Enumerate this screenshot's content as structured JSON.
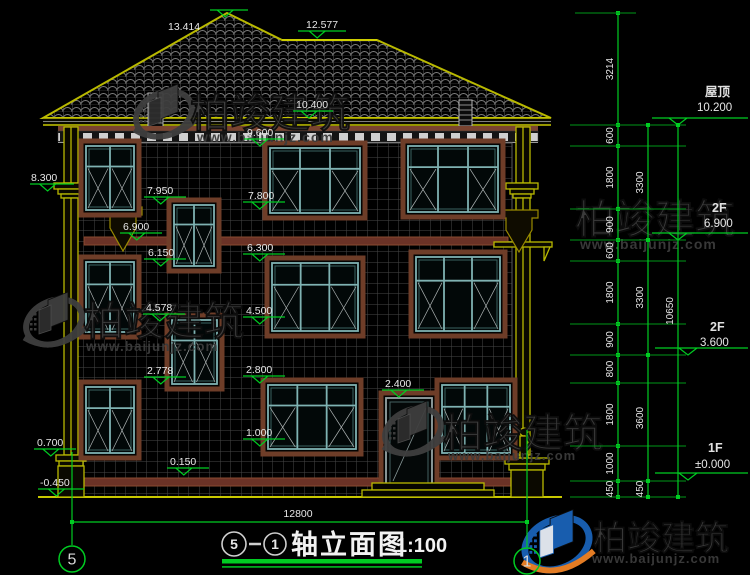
{
  "title": {
    "from": "5",
    "sep": "—",
    "to": "1",
    "name": "轴立面图",
    "scale": "1:100"
  },
  "bottom": {
    "overall_dim": "12800",
    "axis_left": "5",
    "axis_right": "1"
  },
  "watermark": {
    "brand": "柏竣建筑",
    "url": "www.baijunjz.com",
    "instances": [
      {
        "lx": 164,
        "ly": 114,
        "bx": 190,
        "by": 127,
        "bs": 40,
        "ux": 197,
        "uy": 142,
        "us": 14,
        "variant": "gray",
        "logo": true
      },
      {
        "lx": 54,
        "ly": 322,
        "bx": 84,
        "by": 335,
        "bs": 40,
        "ux": 86,
        "uy": 351,
        "us": 13.5,
        "variant": "gray",
        "logo": true
      },
      {
        "lx": 413,
        "ly": 431,
        "bx": 443,
        "by": 447,
        "bs": 40,
        "ux": 448,
        "uy": 460,
        "us": 13,
        "variant": "gray",
        "logo": true
      },
      {
        "lx": 540,
        "ly": 215,
        "bx": 575,
        "by": 233,
        "bs": 40,
        "ux": 580,
        "uy": 249,
        "us": 14,
        "variant": "gray",
        "logo": false
      },
      {
        "lx": 557,
        "ly": 544,
        "bx": 593,
        "by": 550,
        "bs": 34,
        "ux": 592,
        "uy": 563,
        "us": 13,
        "variant": "color",
        "logo": true
      }
    ]
  },
  "elevation_markers": [
    {
      "l": "13.414",
      "y": 17,
      "lx": 210,
      "lw": 38,
      "tx": 168,
      "ty": 30
    },
    {
      "l": "12.577",
      "y": 38,
      "lx": 298,
      "lw": 48,
      "tx": 306,
      "ty": 28
    },
    {
      "l": "10.400",
      "y": 118,
      "lx": 293,
      "lw": 40,
      "tx": 296,
      "ty": 108
    },
    {
      "l": "9.600",
      "y": 146,
      "lx": 244,
      "lw": 40,
      "tx": 247,
      "ty": 136
    },
    {
      "l": "8.300",
      "y": 191,
      "lx": 30,
      "lw": 44,
      "tx": 31,
      "ty": 181
    },
    {
      "l": "7.950",
      "y": 204,
      "lx": 144,
      "lw": 42,
      "tx": 147,
      "ty": 194
    },
    {
      "l": "7.800",
      "y": 209,
      "lx": 243,
      "lw": 42,
      "tx": 248,
      "ty": 199
    },
    {
      "l": "6.900",
      "y": 240,
      "lx": 120,
      "lw": 42,
      "tx": 123,
      "ty": 230
    },
    {
      "l": "6.150",
      "y": 266,
      "lx": 144,
      "lw": 42,
      "tx": 148,
      "ty": 256
    },
    {
      "l": "6.300",
      "y": 261,
      "lx": 243,
      "lw": 42,
      "tx": 247,
      "ty": 251
    },
    {
      "l": "4.578",
      "y": 321,
      "lx": 143,
      "lw": 42,
      "tx": 146,
      "ty": 311
    },
    {
      "l": "4.500",
      "y": 324,
      "lx": 243,
      "lw": 42,
      "tx": 246,
      "ty": 314
    },
    {
      "l": "2.778",
      "y": 384,
      "lx": 144,
      "lw": 42,
      "tx": 147,
      "ty": 374
    },
    {
      "l": "2.800",
      "y": 383,
      "lx": 243,
      "lw": 42,
      "tx": 246,
      "ty": 373
    },
    {
      "l": "2.400",
      "y": 397,
      "lx": 382,
      "lw": 42,
      "tx": 385,
      "ty": 387
    },
    {
      "l": "1.000",
      "y": 446,
      "lx": 243,
      "lw": 42,
      "tx": 246,
      "ty": 436
    },
    {
      "l": "0.700",
      "y": 456,
      "lx": 34,
      "lw": 42,
      "tx": 37,
      "ty": 446
    },
    {
      "l": "0.150",
      "y": 475,
      "lx": 167,
      "lw": 42,
      "tx": 170,
      "ty": 465
    },
    {
      "l": "-0.450",
      "y": 496,
      "lx": 38,
      "lw": 46,
      "tx": 40,
      "ty": 486
    }
  ],
  "right_levels": [
    {
      "floor": "屋顶",
      "value": "10.200",
      "y": 125,
      "fx": 705,
      "fy": 96,
      "vx": 697,
      "vy": 111,
      "lxx": 652,
      "lw": 96,
      "tri": 678
    },
    {
      "floor": "2F",
      "value": "6.900",
      "y": 240,
      "fx": 712,
      "fy": 212,
      "vx": 704,
      "vy": 227,
      "lxx": 652,
      "lw": 96,
      "tri": 678
    },
    {
      "floor": "2F",
      "value": "3.600",
      "y": 355,
      "fx": 710,
      "fy": 331,
      "vx": 700,
      "vy": 346,
      "lxx": 655,
      "lw": 93,
      "tri": 688
    },
    {
      "floor": "1F",
      "value": "±0.000",
      "y": 480,
      "fx": 708,
      "fy": 452,
      "vx": 695,
      "vy": 468,
      "lxx": 655,
      "lw": 93,
      "tri": 688
    }
  ],
  "dim_chains": [
    {
      "x": 618,
      "ticks": [
        13,
        125,
        146,
        209,
        240,
        261,
        324,
        355,
        383,
        446,
        481,
        497
      ],
      "labels": [
        "3214",
        "600",
        "1800",
        "900",
        "600",
        "1800",
        "900",
        "800",
        "1800",
        "1000",
        "450"
      ],
      "ext": true
    },
    {
      "x": 648,
      "ticks": [
        125,
        240,
        355,
        481,
        497
      ],
      "labels": [
        "3300",
        "3300",
        "3600",
        "450"
      ],
      "ext": false
    },
    {
      "x": 678,
      "ticks": [
        125,
        497
      ],
      "labels": [
        "10650"
      ],
      "ext": false
    }
  ],
  "colors": {
    "dim_green": "#00cc22",
    "roof_yellow": "#b9b900",
    "surround_brown": "#6e3d28",
    "window_teal": "#7fb2b2",
    "watermark_gray": "#3f3f3f",
    "logo_blue": "#1a62b8",
    "logo_orange": "#f08326"
  }
}
